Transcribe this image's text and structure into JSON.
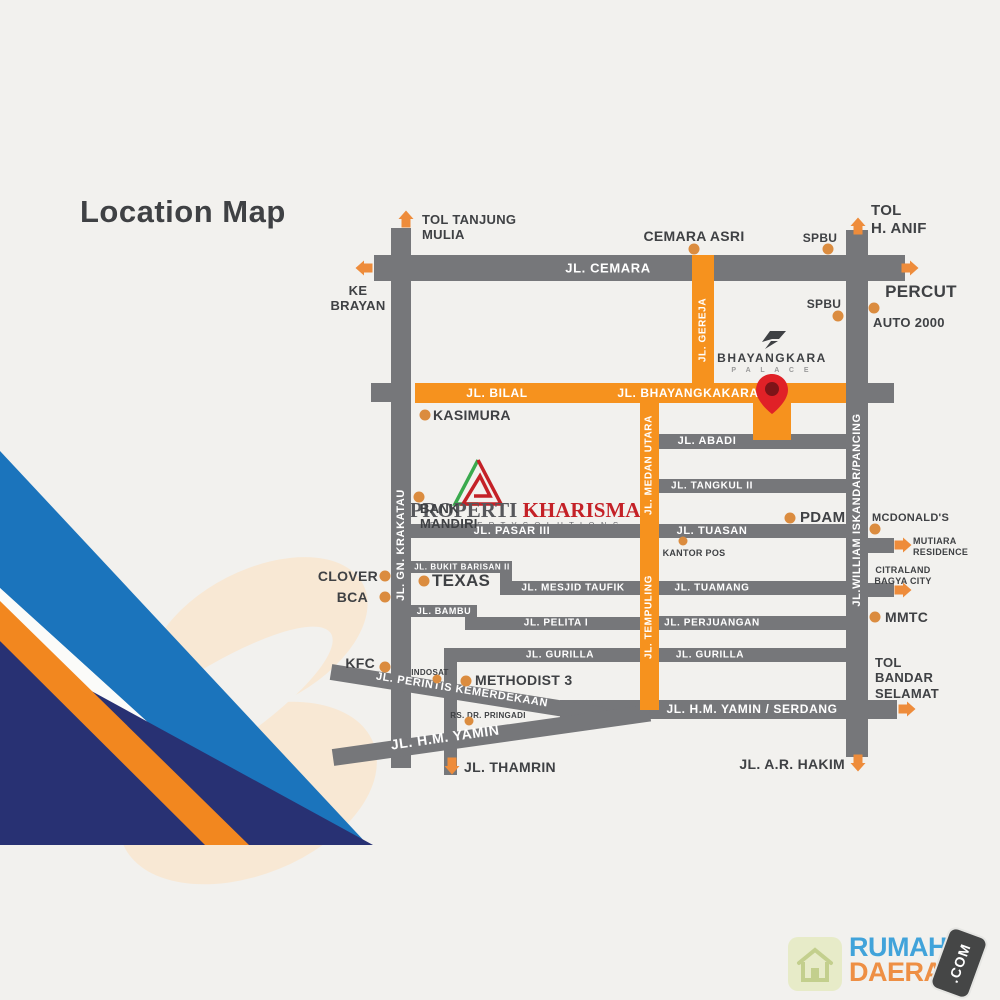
{
  "title": "Location Map",
  "colors": {
    "bg": "#f2f1ee",
    "road_gray": "#76777a",
    "road_orange": "#f6921e",
    "road_text": "#ffffff",
    "text_dark": "#3f4144",
    "dot_orange": "#db8c3f",
    "arrow_orange": "#ee8c3b",
    "pin_red": "#e02127",
    "pin_dark": "#7d1418",
    "navy": "#283173",
    "light_blue": "#1b74bc",
    "stripe_orange": "#f2871f",
    "stripe_white": "#fbfbf9",
    "peach": "#f8e8d4",
    "wm_red": "#c42127",
    "wm_dark": "#56575b",
    "logo_blue": "#41a3da",
    "logo_orange": "#ee8f44",
    "badge_dark": "#454646",
    "house_tile": "#e7ebc8",
    "house_line": "#c3cf8d",
    "site_glyph": "#3f4144"
  },
  "site": {
    "name": "BHAYANGKARA",
    "subtitle": "P A L A C E"
  },
  "watermark": {
    "brand_dark": "PROPERTI",
    "brand_red": " KHARISMA",
    "tagline": "P R O P E R T Y   S O L U T I O N S"
  },
  "footer": {
    "word1": "RUMAH",
    "word2": "DAERAH",
    "tld": ".COM"
  },
  "map": {
    "roads": [
      {
        "x": 391,
        "y": 228,
        "w": 20,
        "h": 540,
        "c": "g"
      },
      {
        "x": 846,
        "y": 230,
        "w": 22,
        "h": 527,
        "c": "g"
      },
      {
        "x": 444,
        "y": 655,
        "w": 13,
        "h": 120,
        "c": "g"
      },
      {
        "x": 500,
        "y": 561,
        "w": 12,
        "h": 30,
        "c": "g"
      },
      {
        "x": 465,
        "y": 605,
        "w": 12,
        "h": 24,
        "c": "g"
      },
      {
        "x": 374,
        "y": 255,
        "w": 531,
        "h": 26,
        "c": "g"
      },
      {
        "x": 371,
        "y": 383,
        "w": 21,
        "h": 19,
        "c": "g"
      },
      {
        "x": 868,
        "y": 383,
        "w": 26,
        "h": 20,
        "c": "g"
      },
      {
        "x": 659,
        "y": 434,
        "w": 187,
        "h": 15,
        "c": "g"
      },
      {
        "x": 659,
        "y": 479,
        "w": 187,
        "h": 14,
        "c": "g"
      },
      {
        "x": 410,
        "y": 524,
        "w": 231,
        "h": 14,
        "c": "g"
      },
      {
        "x": 659,
        "y": 524,
        "w": 187,
        "h": 14,
        "c": "g"
      },
      {
        "x": 410,
        "y": 561,
        "w": 102,
        "h": 12,
        "c": "g"
      },
      {
        "x": 500,
        "y": 581,
        "w": 141,
        "h": 14,
        "c": "g"
      },
      {
        "x": 659,
        "y": 581,
        "w": 187,
        "h": 14,
        "c": "g"
      },
      {
        "x": 410,
        "y": 605,
        "w": 67,
        "h": 12,
        "c": "g"
      },
      {
        "x": 465,
        "y": 617,
        "w": 176,
        "h": 13,
        "c": "g"
      },
      {
        "x": 659,
        "y": 616,
        "w": 187,
        "h": 14,
        "c": "g"
      },
      {
        "x": 444,
        "y": 648,
        "w": 197,
        "h": 14,
        "c": "g"
      },
      {
        "x": 659,
        "y": 648,
        "w": 187,
        "h": 14,
        "c": "g"
      },
      {
        "x": 560,
        "y": 700,
        "w": 337,
        "h": 19,
        "c": "g"
      },
      {
        "x": 868,
        "y": 538,
        "w": 26,
        "h": 15,
        "c": "g"
      },
      {
        "x": 868,
        "y": 583,
        "w": 26,
        "h": 14,
        "c": "g"
      },
      {
        "x": 331,
        "y": 664,
        "w": 278,
        "h": 16,
        "c": "g",
        "deg": 9
      },
      {
        "x": 333,
        "y": 749,
        "w": 320,
        "h": 17,
        "c": "g",
        "deg": -8
      },
      {
        "x": 692,
        "y": 255,
        "w": 22,
        "h": 140,
        "c": "o"
      },
      {
        "x": 640,
        "y": 393,
        "w": 19,
        "h": 317,
        "c": "o"
      },
      {
        "x": 415,
        "y": 383,
        "w": 431,
        "h": 20,
        "c": "o"
      },
      {
        "x": 753,
        "y": 398,
        "w": 38,
        "h": 42,
        "c": "o"
      }
    ],
    "road_labels": [
      {
        "t": "JL. CEMARA",
        "x": 608,
        "y": 268,
        "fs": 13
      },
      {
        "t": "JL. BILAL",
        "x": 497,
        "y": 393,
        "fs": 12
      },
      {
        "t": "JL. BHAYANGKAKARA",
        "x": 688,
        "y": 393,
        "fs": 12
      },
      {
        "t": "JL. ABADI",
        "x": 707,
        "y": 441,
        "fs": 11
      },
      {
        "t": "JL. TANGKUL II",
        "x": 712,
        "y": 486,
        "fs": 10
      },
      {
        "t": "JL. PASAR III",
        "x": 512,
        "y": 531,
        "fs": 11
      },
      {
        "t": "JL. TUASAN",
        "x": 712,
        "y": 531,
        "fs": 11
      },
      {
        "t": "JL. BUKIT BARISAN II",
        "x": 462,
        "y": 567,
        "fs": 8
      },
      {
        "t": "JL. MESJID TAUFIK",
        "x": 573,
        "y": 588,
        "fs": 10
      },
      {
        "t": "JL. TUAMANG",
        "x": 712,
        "y": 588,
        "fs": 10
      },
      {
        "t": "JL. BAMBU",
        "x": 444,
        "y": 611,
        "fs": 9
      },
      {
        "t": "JL. PELITA I",
        "x": 556,
        "y": 623,
        "fs": 10
      },
      {
        "t": "JL. PERJUANGAN",
        "x": 712,
        "y": 623,
        "fs": 10
      },
      {
        "t": "JL. GURILLA",
        "x": 560,
        "y": 655,
        "fs": 10
      },
      {
        "t": "JL. GURILLA",
        "x": 710,
        "y": 655,
        "fs": 10
      },
      {
        "t": "JL. H.M. YAMIN / SERDANG",
        "x": 752,
        "y": 709,
        "fs": 12
      },
      {
        "t": "JL. PERINTIS KEMERDEKAAN",
        "x": 462,
        "y": 690,
        "fs": 11,
        "deg": 9
      },
      {
        "t": "JL. H.M. YAMIN",
        "x": 445,
        "y": 737,
        "fs": 14,
        "deg": -8
      },
      {
        "t": "JL. GN. KRAKATAU",
        "x": 401,
        "y": 545,
        "fs": 11,
        "deg": -90
      },
      {
        "t": "JL. GEREJA",
        "x": 703,
        "y": 330,
        "fs": 10,
        "deg": -90
      },
      {
        "t": "JL. MEDAN UTARA",
        "x": 649,
        "y": 465,
        "fs": 10,
        "deg": -90
      },
      {
        "t": "JL. TEMPULING",
        "x": 649,
        "y": 617,
        "fs": 10,
        "deg": -90
      },
      {
        "t": "JL.WILLIAM ISKANDAR/PANCING",
        "x": 857,
        "y": 510,
        "fs": 11,
        "deg": -90
      }
    ],
    "pois": [
      {
        "t": "TOL TANJUNG\nMULIA",
        "x": 422,
        "y": 212,
        "fs": 13,
        "ta": "l"
      },
      {
        "t": "KE\nBRAYAN",
        "x": 358,
        "y": 283,
        "fs": 13,
        "ta": "c"
      },
      {
        "t": "CEMARA ASRI",
        "x": 694,
        "y": 228,
        "fs": 14,
        "ta": "c"
      },
      {
        "t": "SPBU",
        "x": 820,
        "y": 231,
        "fs": 12,
        "ta": "c"
      },
      {
        "t": "SPBU",
        "x": 824,
        "y": 297,
        "fs": 12,
        "ta": "c"
      },
      {
        "t": "TOL\nH. ANIF",
        "x": 871,
        "y": 202,
        "fs": 15,
        "ta": "l"
      },
      {
        "t": "PERCUT",
        "x": 921,
        "y": 282,
        "fs": 17,
        "ta": "c"
      },
      {
        "t": "AUTO 2000",
        "x": 873,
        "y": 315,
        "fs": 13,
        "ta": "l"
      },
      {
        "t": "KASIMURA",
        "x": 433,
        "y": 407,
        "fs": 14,
        "ta": "l"
      },
      {
        "t": "BANK\nMANDIRI",
        "x": 420,
        "y": 501,
        "fs": 13,
        "ta": "l"
      },
      {
        "t": "PDAM",
        "x": 800,
        "y": 509,
        "fs": 15,
        "ta": "l"
      },
      {
        "t": "MCDONALD'S",
        "x": 872,
        "y": 512,
        "fs": 11,
        "ta": "l"
      },
      {
        "t": "MUTIARA\nRESIDENCE",
        "x": 913,
        "y": 536,
        "fs": 9,
        "ta": "l"
      },
      {
        "t": "CITRALAND\nBAGYA CITY",
        "x": 903,
        "y": 565,
        "fs": 9,
        "ta": "c"
      },
      {
        "t": "KANTOR POS",
        "x": 694,
        "y": 548,
        "fs": 9,
        "ta": "c"
      },
      {
        "t": "CLOVER",
        "x": 378,
        "y": 568,
        "fs": 14,
        "ta": "r"
      },
      {
        "t": "BCA",
        "x": 368,
        "y": 589,
        "fs": 14,
        "ta": "r"
      },
      {
        "t": "TEXAS",
        "x": 432,
        "y": 571,
        "fs": 17,
        "ta": "l"
      },
      {
        "t": "MMTC",
        "x": 885,
        "y": 609,
        "fs": 14,
        "ta": "l"
      },
      {
        "t": "KFC",
        "x": 375,
        "y": 655,
        "fs": 14,
        "ta": "r"
      },
      {
        "t": "INDOSAT",
        "x": 430,
        "y": 668,
        "fs": 8,
        "ta": "c"
      },
      {
        "t": "METHODIST 3",
        "x": 475,
        "y": 672,
        "fs": 14,
        "ta": "l"
      },
      {
        "t": "RS. DR. PRINGADI",
        "x": 488,
        "y": 711,
        "fs": 8,
        "ta": "c"
      },
      {
        "t": "TOL\nBANDAR\nSELAMAT",
        "x": 875,
        "y": 655,
        "fs": 13,
        "ta": "l"
      },
      {
        "t": "JL. A.R. HAKIM",
        "x": 845,
        "y": 756,
        "fs": 14,
        "ta": "r"
      },
      {
        "t": "JL. THAMRIN",
        "x": 464,
        "y": 759,
        "fs": 14,
        "ta": "l"
      }
    ],
    "dots": [
      {
        "x": 694,
        "y": 249
      },
      {
        "x": 828,
        "y": 249
      },
      {
        "x": 838,
        "y": 316
      },
      {
        "x": 874,
        "y": 308
      },
      {
        "x": 425,
        "y": 415
      },
      {
        "x": 419,
        "y": 497
      },
      {
        "x": 790,
        "y": 518
      },
      {
        "x": 875,
        "y": 529
      },
      {
        "x": 683,
        "y": 541,
        "d": 9
      },
      {
        "x": 385,
        "y": 576
      },
      {
        "x": 385,
        "y": 597
      },
      {
        "x": 424,
        "y": 581
      },
      {
        "x": 875,
        "y": 617
      },
      {
        "x": 385,
        "y": 667
      },
      {
        "x": 437,
        "y": 679,
        "d": 9
      },
      {
        "x": 466,
        "y": 681
      },
      {
        "x": 469,
        "y": 721,
        "d": 9
      }
    ],
    "arrows": [
      {
        "x": 406,
        "y": 219,
        "dir": "up"
      },
      {
        "x": 858,
        "y": 226,
        "dir": "up"
      },
      {
        "x": 364,
        "y": 268,
        "dir": "left"
      },
      {
        "x": 910,
        "y": 268,
        "dir": "right"
      },
      {
        "x": 903,
        "y": 545,
        "dir": "right"
      },
      {
        "x": 903,
        "y": 590,
        "dir": "right"
      },
      {
        "x": 907,
        "y": 709,
        "dir": "right"
      },
      {
        "x": 452,
        "y": 766,
        "dir": "down"
      },
      {
        "x": 858,
        "y": 763,
        "dir": "down"
      }
    ]
  }
}
